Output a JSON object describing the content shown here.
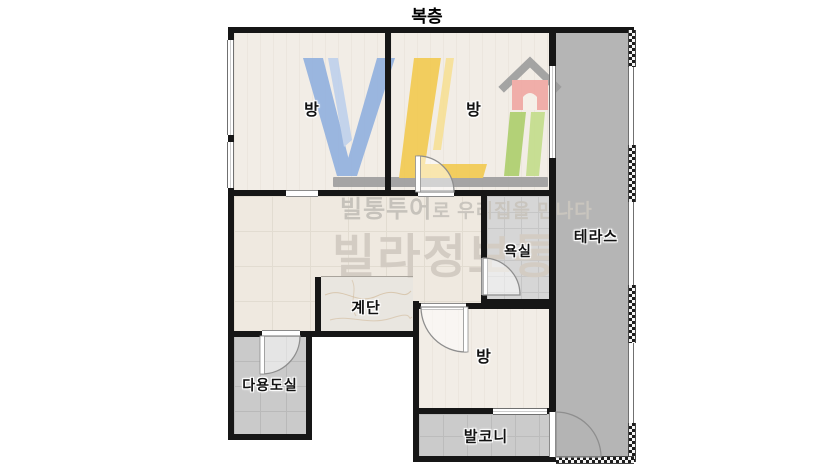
{
  "title": "복층",
  "rooms": {
    "bedroom_top_left": {
      "label": "방"
    },
    "bedroom_top_middle": {
      "label": "방"
    },
    "bedroom_bottom": {
      "label": "방"
    },
    "terrace": {
      "label": "테라스"
    },
    "bathroom": {
      "label": "욕실"
    },
    "stairs": {
      "label": "계단"
    },
    "utility": {
      "label": "다용도실"
    },
    "balcony": {
      "label": "발코니"
    }
  },
  "watermark": {
    "slogan_bold": "빌통투어",
    "slogan_rest": "로 우리집을 만나다",
    "brand": "빌라정보통",
    "logo_letters": "VL",
    "logo_icons": [
      "letter-v-icon",
      "letter-l-icon",
      "house-icon",
      "book-spines-icon",
      "shelf-icon"
    ]
  },
  "palette": {
    "wall": "#161616",
    "bedroom_floor": "#f2ede6",
    "hall_floor": "#efe9e0",
    "bath_floor": "#d6d6d6",
    "utility_floor": "#cacaca",
    "balcony_floor": "#cbcbcb",
    "terrace_floor": "#b5b5b5",
    "stairs_floor": "#e9e6e0",
    "logo_blue": "#8fafdf",
    "logo_blue_light": "#bdd0ec",
    "logo_yellow": "#f2c94c",
    "logo_yellow_pale": "#f7e094",
    "logo_red": "#f0a6a1",
    "logo_green": "#abce68",
    "logo_green_light": "#c2dc88",
    "logo_gray": "#9b9b9b",
    "watermark_text": "#c6c2bb",
    "watermark_brand": "#d3ccc3",
    "label_text": "#111111"
  }
}
